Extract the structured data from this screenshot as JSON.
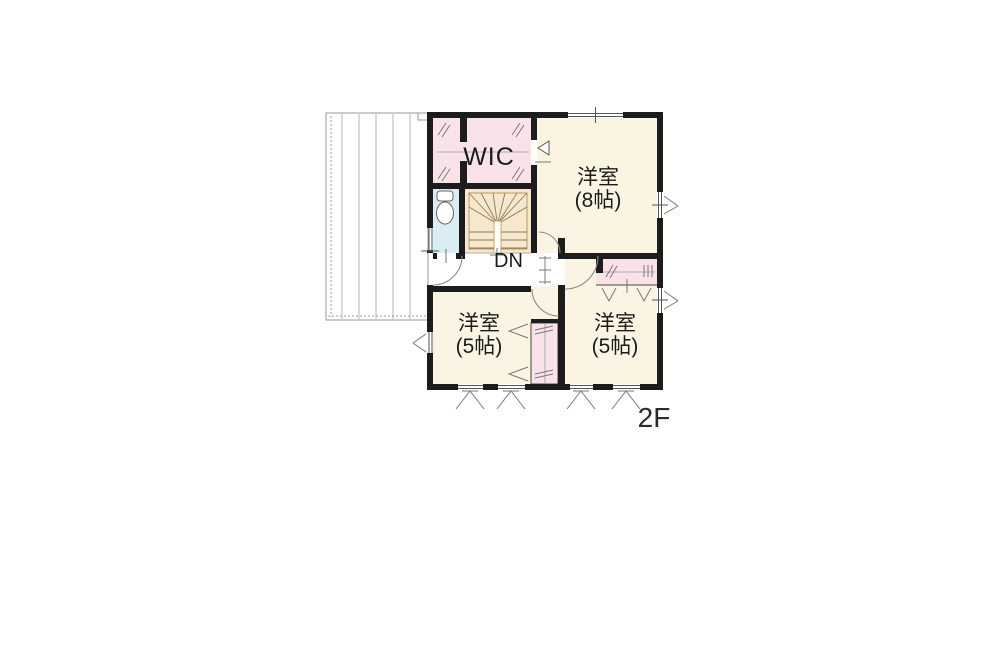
{
  "floor_label": "2F",
  "stairs": {
    "direction_label": "DN"
  },
  "rooms": {
    "wic": {
      "name": "WIC"
    },
    "bedroom8": {
      "name": "洋室",
      "size": "(8帖)"
    },
    "bedroom5_left": {
      "name": "洋室",
      "size": "(5帖)"
    },
    "bedroom5_right": {
      "name": "洋室",
      "size": "(5帖)"
    }
  },
  "colors": {
    "wall": "#1c1c1c",
    "room_cream": "#faf4e2",
    "closet_pink": "#fae3e8",
    "toilet_blue": "#d9edf2",
    "stairs_tan": "#f6e8cd",
    "stairs_border": "#bf9862",
    "balcony_gray": "#9a9a9a",
    "door_arc": "#8a8a8a",
    "text": "#1b1b1b"
  }
}
